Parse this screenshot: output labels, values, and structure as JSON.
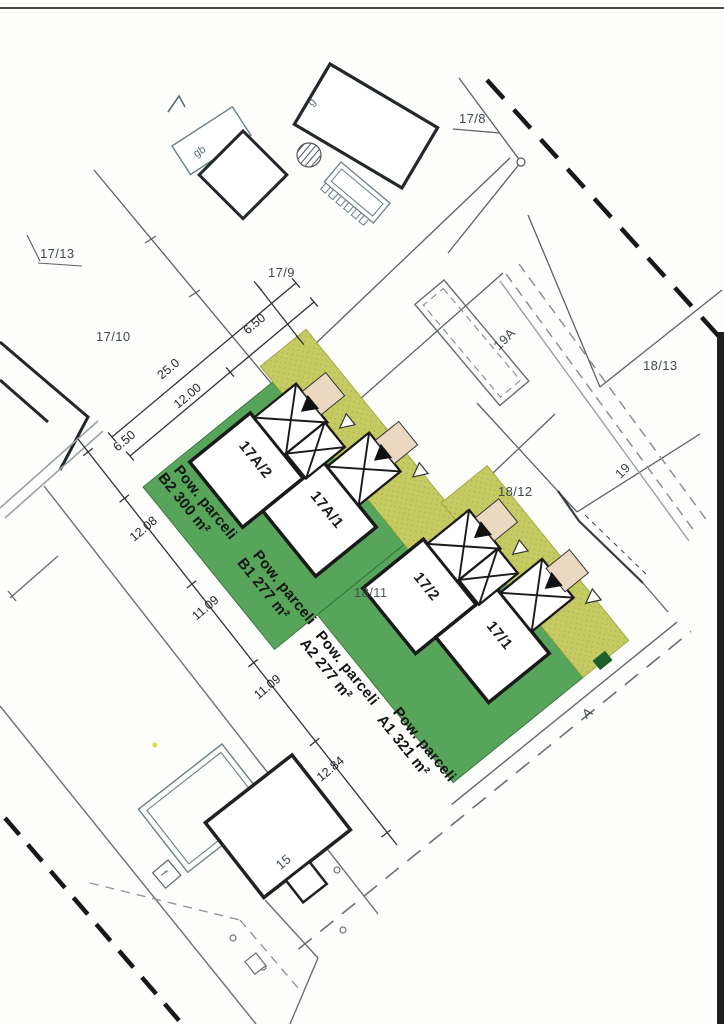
{
  "labels": {
    "p17_8": "17/8",
    "p17_9": "17/9",
    "p17_10": "17/10",
    "p17_13": "17/13",
    "p18_11": "18/11",
    "p18_12": "18/12",
    "p18_13": "18/13",
    "p19": "19",
    "p19a": "19A",
    "p15": "15",
    "road_a": "A",
    "bldg_g": "g",
    "bldg_gb": "gb",
    "bldg_f": "f"
  },
  "houses": {
    "h17a2": "17A/2",
    "h17a1": "17A/1",
    "h17_2": "17/2",
    "h17_1": "17/1"
  },
  "plots": {
    "b2": {
      "line1": "Pow. parceli",
      "line2": "B2  300 m²"
    },
    "b1": {
      "line1": "Pow. parceli",
      "line2": "B1  277 m²"
    },
    "a2": {
      "line1": "Pow. parceli",
      "line2": "A2  277 m²"
    },
    "a1": {
      "line1": "Pow. parceli",
      "line2": "A1  321 m²"
    }
  },
  "dims": {
    "top_650": "6.50",
    "d25": "25.0",
    "d12": "12.00",
    "front_650": "6.50",
    "d1208": "12.08",
    "d1109a": "11.09",
    "d1109b": "11.09",
    "d1284": "12.84"
  },
  "colors": {
    "green": "#57a55a",
    "olive": "#c6ca62",
    "beige": "#ead9c0"
  }
}
